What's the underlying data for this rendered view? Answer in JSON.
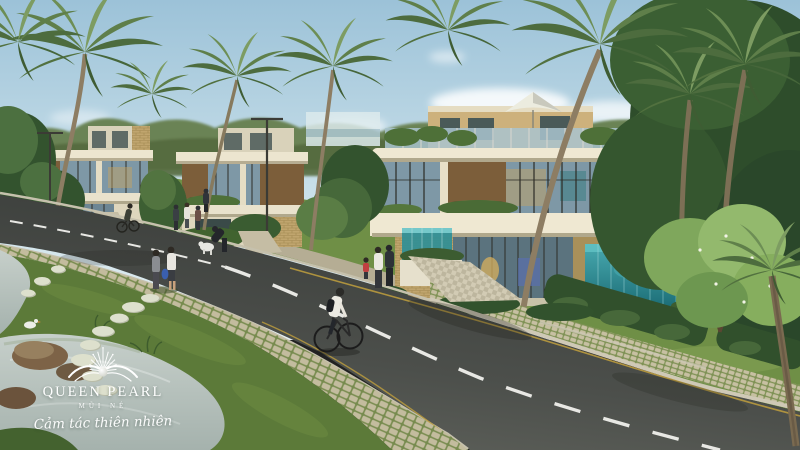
{
  "window": {
    "width": 800,
    "height": 450
  },
  "branding": {
    "emblem_icon": "pearl-burst-icon",
    "title": "QUEEN PEARL",
    "subtitle": "MŨI NÉ",
    "tagline": "Cảm tác thiên nhiên",
    "text_color": "#ffffff"
  },
  "palette": {
    "sky_top": "#9cc2d8",
    "sky_horizon": "#e6eff1",
    "palm_green": "#5f7f4a",
    "lawn_far": "#6f8f46",
    "lawn_near": "#5c7a39",
    "road_asphalt": "#4a4d49",
    "lane_marking_white": "#e8e8e4",
    "edge_line_yellow": "#b99a3e",
    "building_cream": "#efe8d2",
    "brick_tan": "#c0a56e",
    "glass_blue": "#7e98a6",
    "wood_louver": "#8a6b43",
    "pool_teal": "#2a8a92",
    "paver_stone": "#c7c0a2",
    "water_gray": "#b6c2bd"
  },
  "scene": {
    "kind": "architectural-render",
    "subject": "seaside villa streetscape with palm trees",
    "elements": [
      "sky",
      "clouds",
      "distant-treeline",
      "modern-villas",
      "rooftop-umbrella",
      "terrace-umbrella",
      "glass-pool",
      "asphalt-road",
      "lane-markings",
      "grass-grid-pavers",
      "hedges",
      "lawns",
      "stream-pond",
      "stepping-stones",
      "rocks",
      "pedestrians",
      "cyclists",
      "dog",
      "white-duck",
      "street-lamps",
      "palm-trees",
      "frangipani-tree"
    ]
  }
}
